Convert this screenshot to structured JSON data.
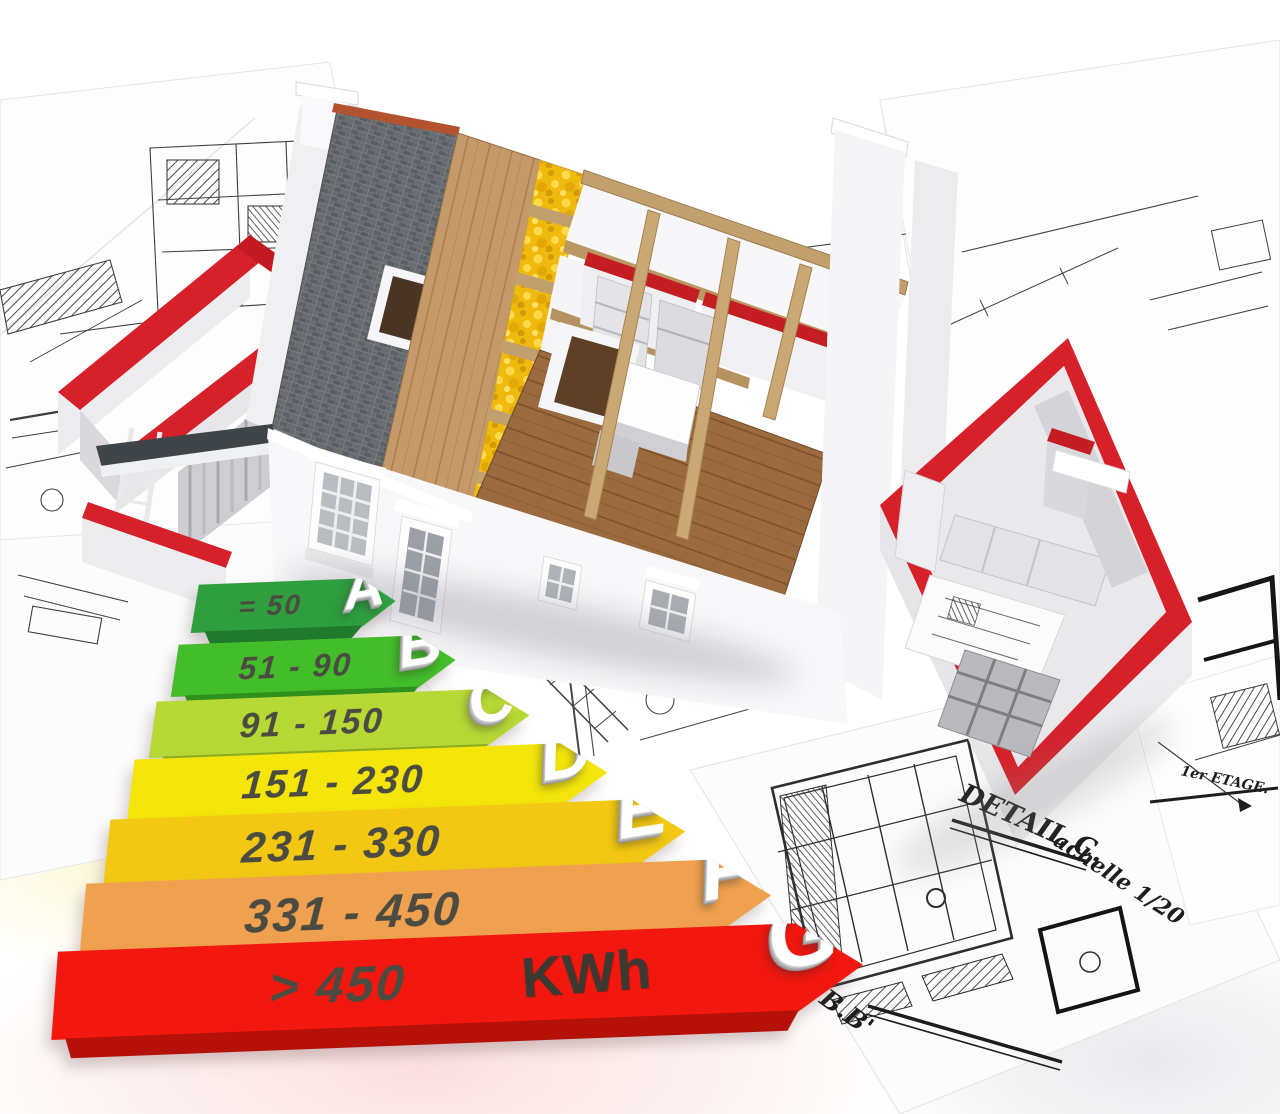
{
  "scene": {
    "type": "3d-architecture-render",
    "description": "Cutaway 3D house under construction standing on architect blueprints, with a 3D energy-efficiency rating arrow scale in the foreground",
    "palette": {
      "slate_roof": "#63686c",
      "wood_sheathing": "#c59a6a",
      "insulation": "#f2bd0e",
      "wood_floor": "#9b6a3f",
      "wall_red": "#d6202a",
      "beam_wood": "#c2a06e"
    }
  },
  "energy_chart": {
    "type": "bar",
    "title": "Energy consumption rating scale",
    "unit": "KWh",
    "bars": [
      {
        "grade": "A",
        "range": "= 50",
        "color": "#2f9e3f",
        "shadow": "#1f7a2c"
      },
      {
        "grade": "B",
        "range": "51 - 90",
        "color": "#43bd2a",
        "shadow": "#2e911c"
      },
      {
        "grade": "C",
        "range": "91 - 150",
        "color": "#b7d936",
        "shadow": "#8fae1f"
      },
      {
        "grade": "D",
        "range": "151 - 230",
        "color": "#f4e60a",
        "shadow": "#c4b800"
      },
      {
        "grade": "E",
        "range": "231 - 330",
        "color": "#f3c813",
        "shadow": "#c79e07"
      },
      {
        "grade": "F",
        "range": "331 - 450",
        "color": "#f0a14f",
        "shadow": "#c67c33"
      },
      {
        "grade": "G",
        "range": "> 450",
        "color": "#f2180f",
        "shadow": "#b51108"
      }
    ]
  },
  "annotations": {
    "detail_label": "DETAIL C.",
    "scale_label": "achelle 1/20",
    "floor_label": "1er ETAGE.",
    "section_label": "B.B'"
  }
}
